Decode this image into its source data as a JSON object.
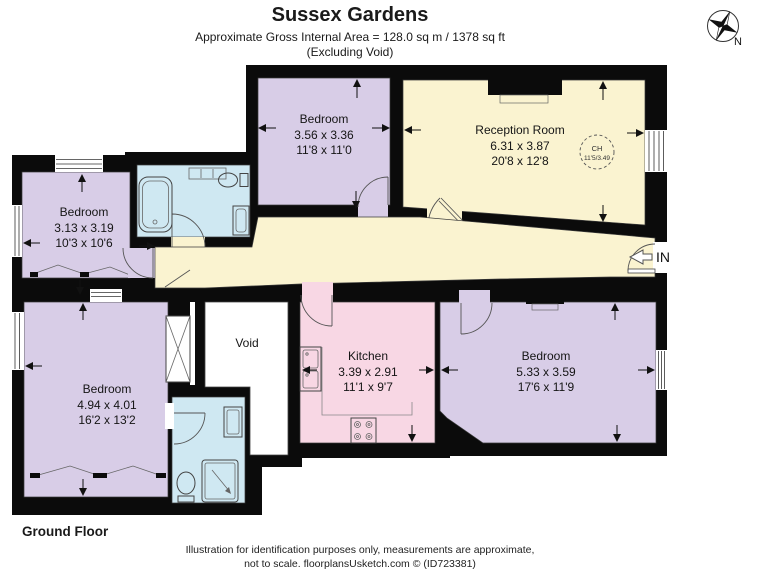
{
  "header": {
    "title": "Sussex Gardens",
    "subtitle": "Approximate Gross Internal Area = 128.0 sq m / 1378 sq ft",
    "note": "(Excluding Void)"
  },
  "compass": {
    "label": "N"
  },
  "entrance": {
    "label": "IN"
  },
  "floor_label": "Ground Floor",
  "rooms": [
    {
      "id": "bedroom-top",
      "name": "Bedroom",
      "metric": "3.56 x 3.36",
      "imperial": "11'8 x 11'0"
    },
    {
      "id": "reception",
      "name": "Reception Room",
      "metric": "6.31 x 3.87",
      "imperial": "20'8 x 12'8",
      "ch_label": "CH",
      "ch_value": "11'5/3.49"
    },
    {
      "id": "bedroom-left",
      "name": "Bedroom",
      "metric": "3.13 x 3.19",
      "imperial": "10'3 x 10'6"
    },
    {
      "id": "bedroom-bottom-left",
      "name": "Bedroom",
      "metric": "4.94 x 4.01",
      "imperial": "16'2 x 13'2"
    },
    {
      "id": "void",
      "name": "Void"
    },
    {
      "id": "kitchen",
      "name": "Kitchen",
      "metric": "3.39 x 2.91",
      "imperial": "11'1 x 9'7"
    },
    {
      "id": "bedroom-bottom-right",
      "name": "Bedroom",
      "metric": "5.33 x 3.59",
      "imperial": "17'6 x 11'9"
    }
  ],
  "footer": {
    "line1": "Illustration for identification purposes only, measurements are approximate,",
    "line2": "not to scale. floorplansUsketch.com © (ID723381)"
  },
  "colors": {
    "room_purple": "#d8cde7",
    "room_yellow": "#faf3d0",
    "room_blue": "#cfe8f2",
    "room_pink": "#f8d7e4",
    "wall": "#0b0b0b"
  }
}
